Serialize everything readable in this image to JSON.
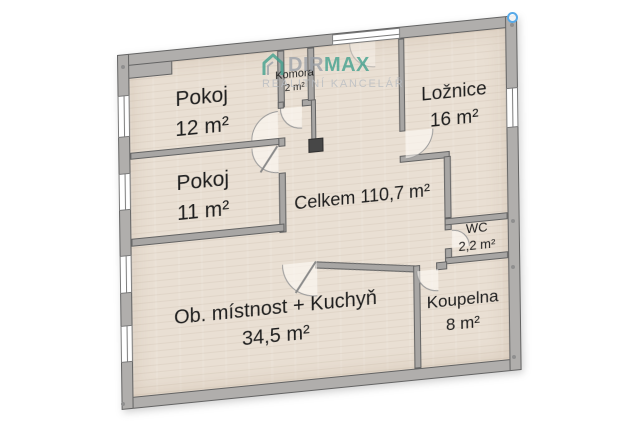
{
  "floorplan": {
    "total_label": "Celkem 110,7 m²",
    "rooms": [
      {
        "name": "Pokoj",
        "area": "12 m²"
      },
      {
        "name": "Pokoj",
        "area": "11 m²"
      },
      {
        "name": "Ložnice",
        "area": "16 m²"
      },
      {
        "name": "Komora",
        "area": "2 m²"
      },
      {
        "name": "WC",
        "area": "2,2 m²"
      },
      {
        "name": "Koupelna",
        "area": "8 m²"
      },
      {
        "name": "Ob. místnost + Kuchyň",
        "area": "34,5 m²"
      }
    ],
    "colors": {
      "wall_fill": "#b0aeac",
      "wall_outline": "#636363",
      "floor": "#e9dfd3",
      "chimney": "#474747",
      "handle": "#57a9e8",
      "marker_dot": "#8f8f8f"
    }
  },
  "watermark": {
    "logo_icon": "house-icon",
    "brand_prefix": "DIR",
    "brand_suffix": "MAX",
    "subtitle": "REALITNÍ KANCELÁŘ",
    "brand_prefix_color": "#9aa0a8",
    "brand_suffix_color": "#3fa08d",
    "subtitle_color": "#b7bcc2"
  }
}
